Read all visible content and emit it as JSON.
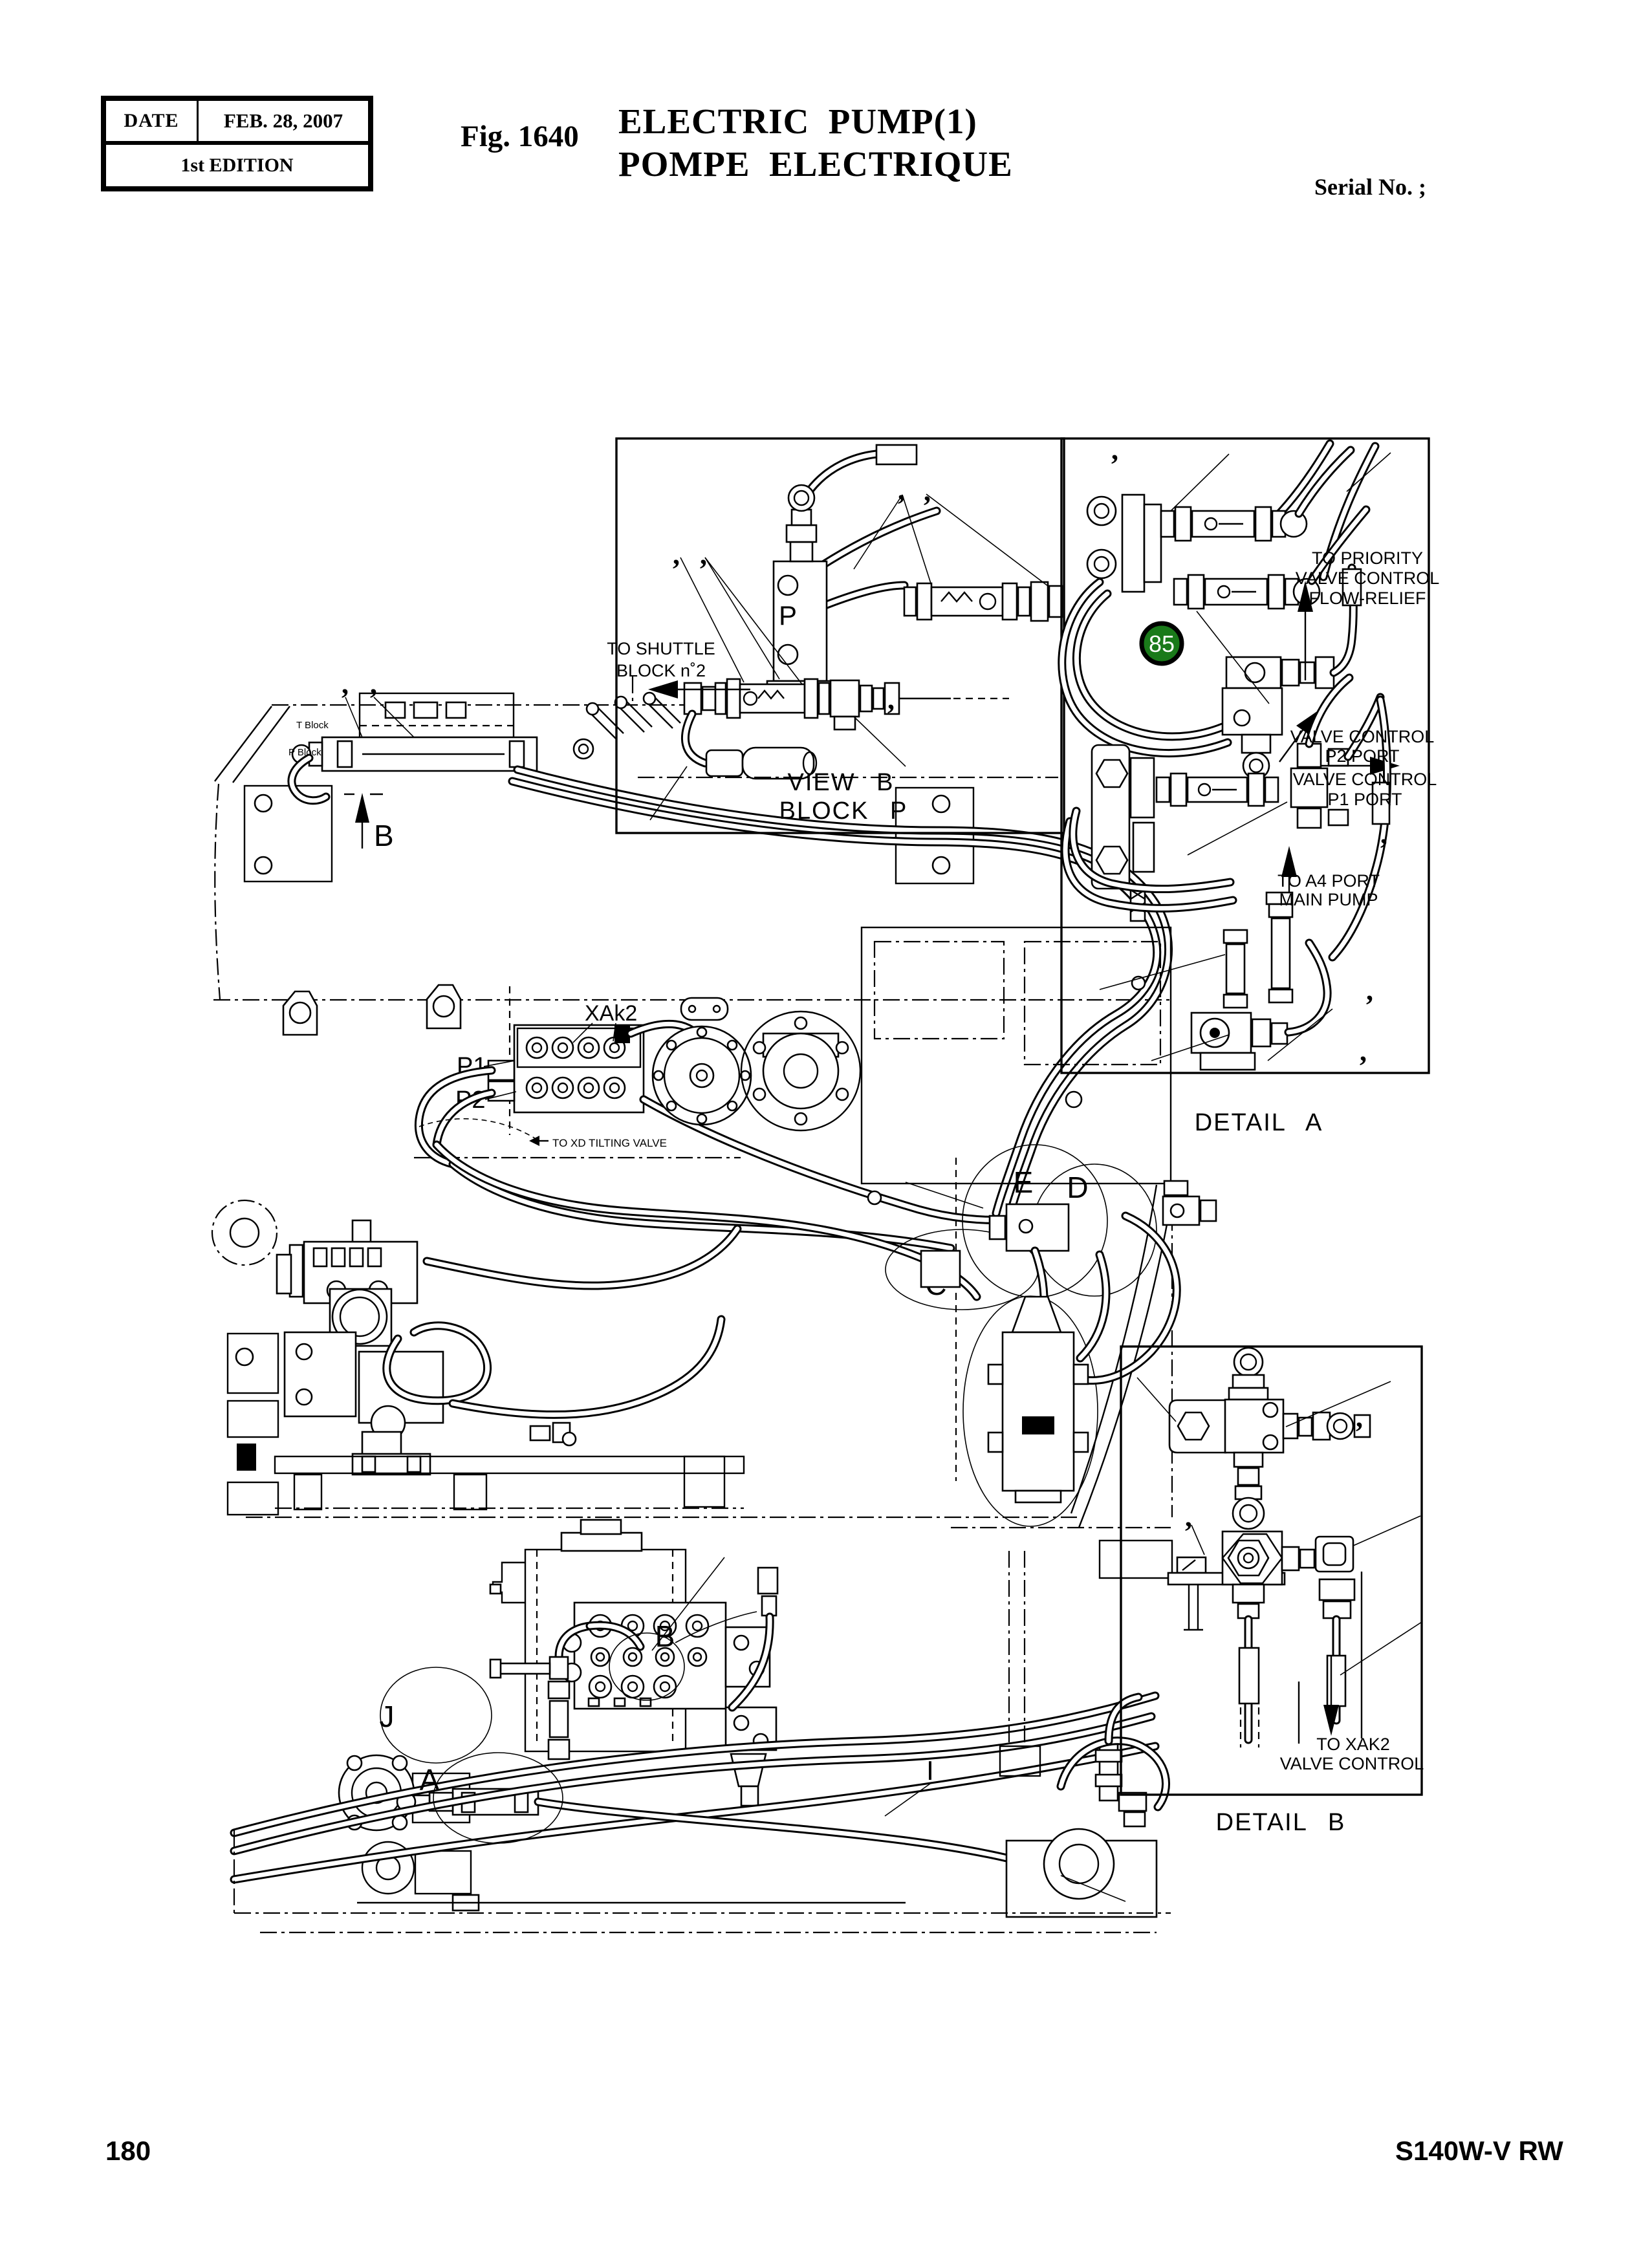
{
  "header": {
    "date_label": "DATE",
    "date_value": "FEB. 28, 2007",
    "edition": "1st EDITION",
    "fig_label": "Fig. 1640",
    "title_en": "ELECTRIC  PUMP(1)",
    "title_fr": "POMPE  ELECTRIQUE",
    "serial_label": "Serial No. ;"
  },
  "footer": {
    "page_number": "180",
    "doc_code": "S140W-V RW"
  },
  "panels": {
    "view_b": {
      "caption1": "VIEW B",
      "caption2": "BLOCK P",
      "port": "P",
      "note1": "TO SHUTTLE",
      "note2": "BLOCK n˚2"
    },
    "detail_a": {
      "caption": "DETAIL A",
      "badge": "85",
      "badge_color": "#1a7a1a",
      "priority1": "TO PRIORITY",
      "priority2": "VALVE CONTROL",
      "priority3": "FLOW-RELIEF",
      "p2_1": "VALVE CONTROL",
      "p2_2": "P2 PORT",
      "p1_1": "VALVE CONTROL",
      "p1_2": "P1 PORT",
      "a4_1": "TO A4 PORT",
      "a4_2": "MAIN PUMP"
    },
    "detail_b": {
      "caption": "DETAIL B",
      "note1": "TO XAK2",
      "note2": "VALVE CONTROL"
    }
  },
  "machine": {
    "upper": {
      "xak2": "XAk2",
      "p1": "P1",
      "p2": "P2",
      "view_b_arrow": "B",
      "label_e": "E",
      "label_d": "D",
      "label_c": "C",
      "label_g": "G",
      "t_block": "T Block",
      "p_block": "P Block",
      "tilting": "TO XD TILTING VALVE"
    },
    "lower": {
      "label_a": "A",
      "label_b": "B",
      "label_j": "J",
      "label_i": "I"
    }
  },
  "marks": {
    "comma": ","
  }
}
